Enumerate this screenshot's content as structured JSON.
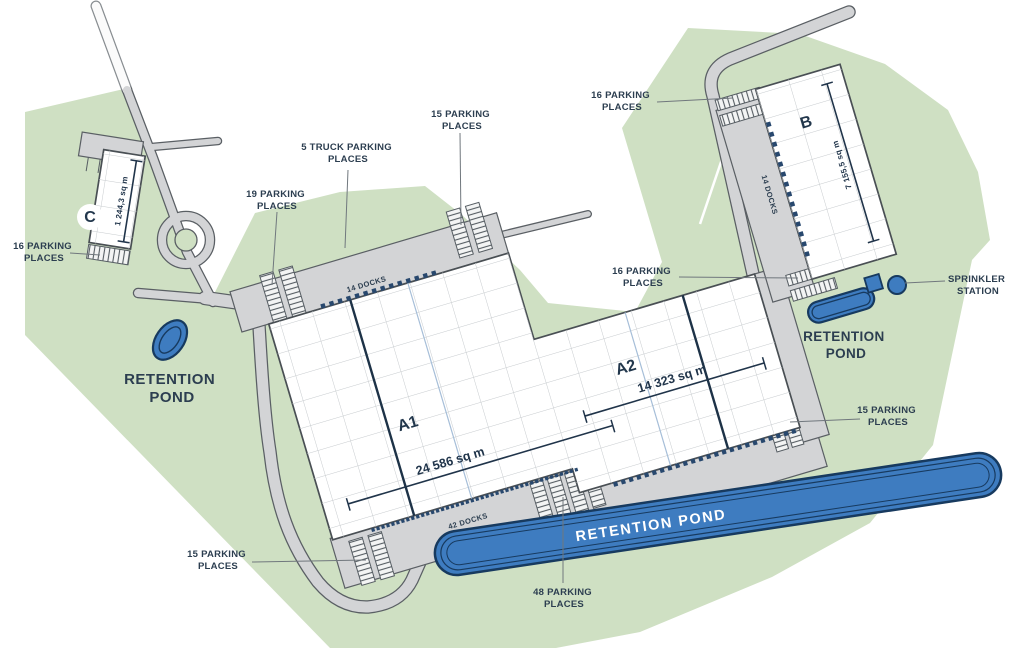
{
  "site": {
    "title": "Industrial park site plan",
    "buildings": {
      "a1": {
        "label": "A1",
        "area": "24 586 sq m",
        "docks_top": "14 DOCKS",
        "docks_bottom": "42 DOCKS"
      },
      "a2": {
        "label": "A2",
        "area": "14 323 sq m"
      },
      "b": {
        "label": "B",
        "area": "7 155,5 sq m",
        "docks": "14 DOCKS"
      },
      "c": {
        "label": "C",
        "area": "1 244,3 sq m"
      }
    },
    "labels": {
      "c_parking": {
        "line1": "16 PARKING",
        "line2": "PLACES"
      },
      "pond_left": {
        "line1": "RETENTION",
        "line2": "POND"
      },
      "parking19": {
        "line1": "19 PARKING",
        "line2": "PLACES"
      },
      "truck5": {
        "line1": "5 TRUCK PARKING",
        "line2": "PLACES"
      },
      "parking15_top": {
        "line1": "15 PARKING",
        "line2": "PLACES"
      },
      "b_parking_top": {
        "line1": "16 PARKING",
        "line2": "PLACES"
      },
      "b_parking_mid": {
        "line1": "16 PARKING",
        "line2": "PLACES"
      },
      "sprinkler": {
        "line1": "SPRINKLER",
        "line2": "STATION"
      },
      "pond_right": {
        "line1": "RETENTION",
        "line2": "POND"
      },
      "parking15_right": {
        "line1": "15 PARKING",
        "line2": "PLACES"
      },
      "parking48": {
        "line1": "48 PARKING",
        "line2": "PLACES"
      },
      "parking15_bl": {
        "line1": "15 PARKING",
        "line2": "PLACES"
      },
      "pond_bottom_banner": "RETENTION POND"
    },
    "colors": {
      "landscape_green": "#cfe0c3",
      "road_gray": "#d3d4d6",
      "road_edge": "#5a5f64",
      "building_white": "#ffffff",
      "grid_line": "#c7cbce",
      "dock_blue": "#28486e",
      "pond_blue": "#3e7cc0",
      "pond_edge": "#173a5f",
      "text_navy": "#2c3e50"
    }
  }
}
